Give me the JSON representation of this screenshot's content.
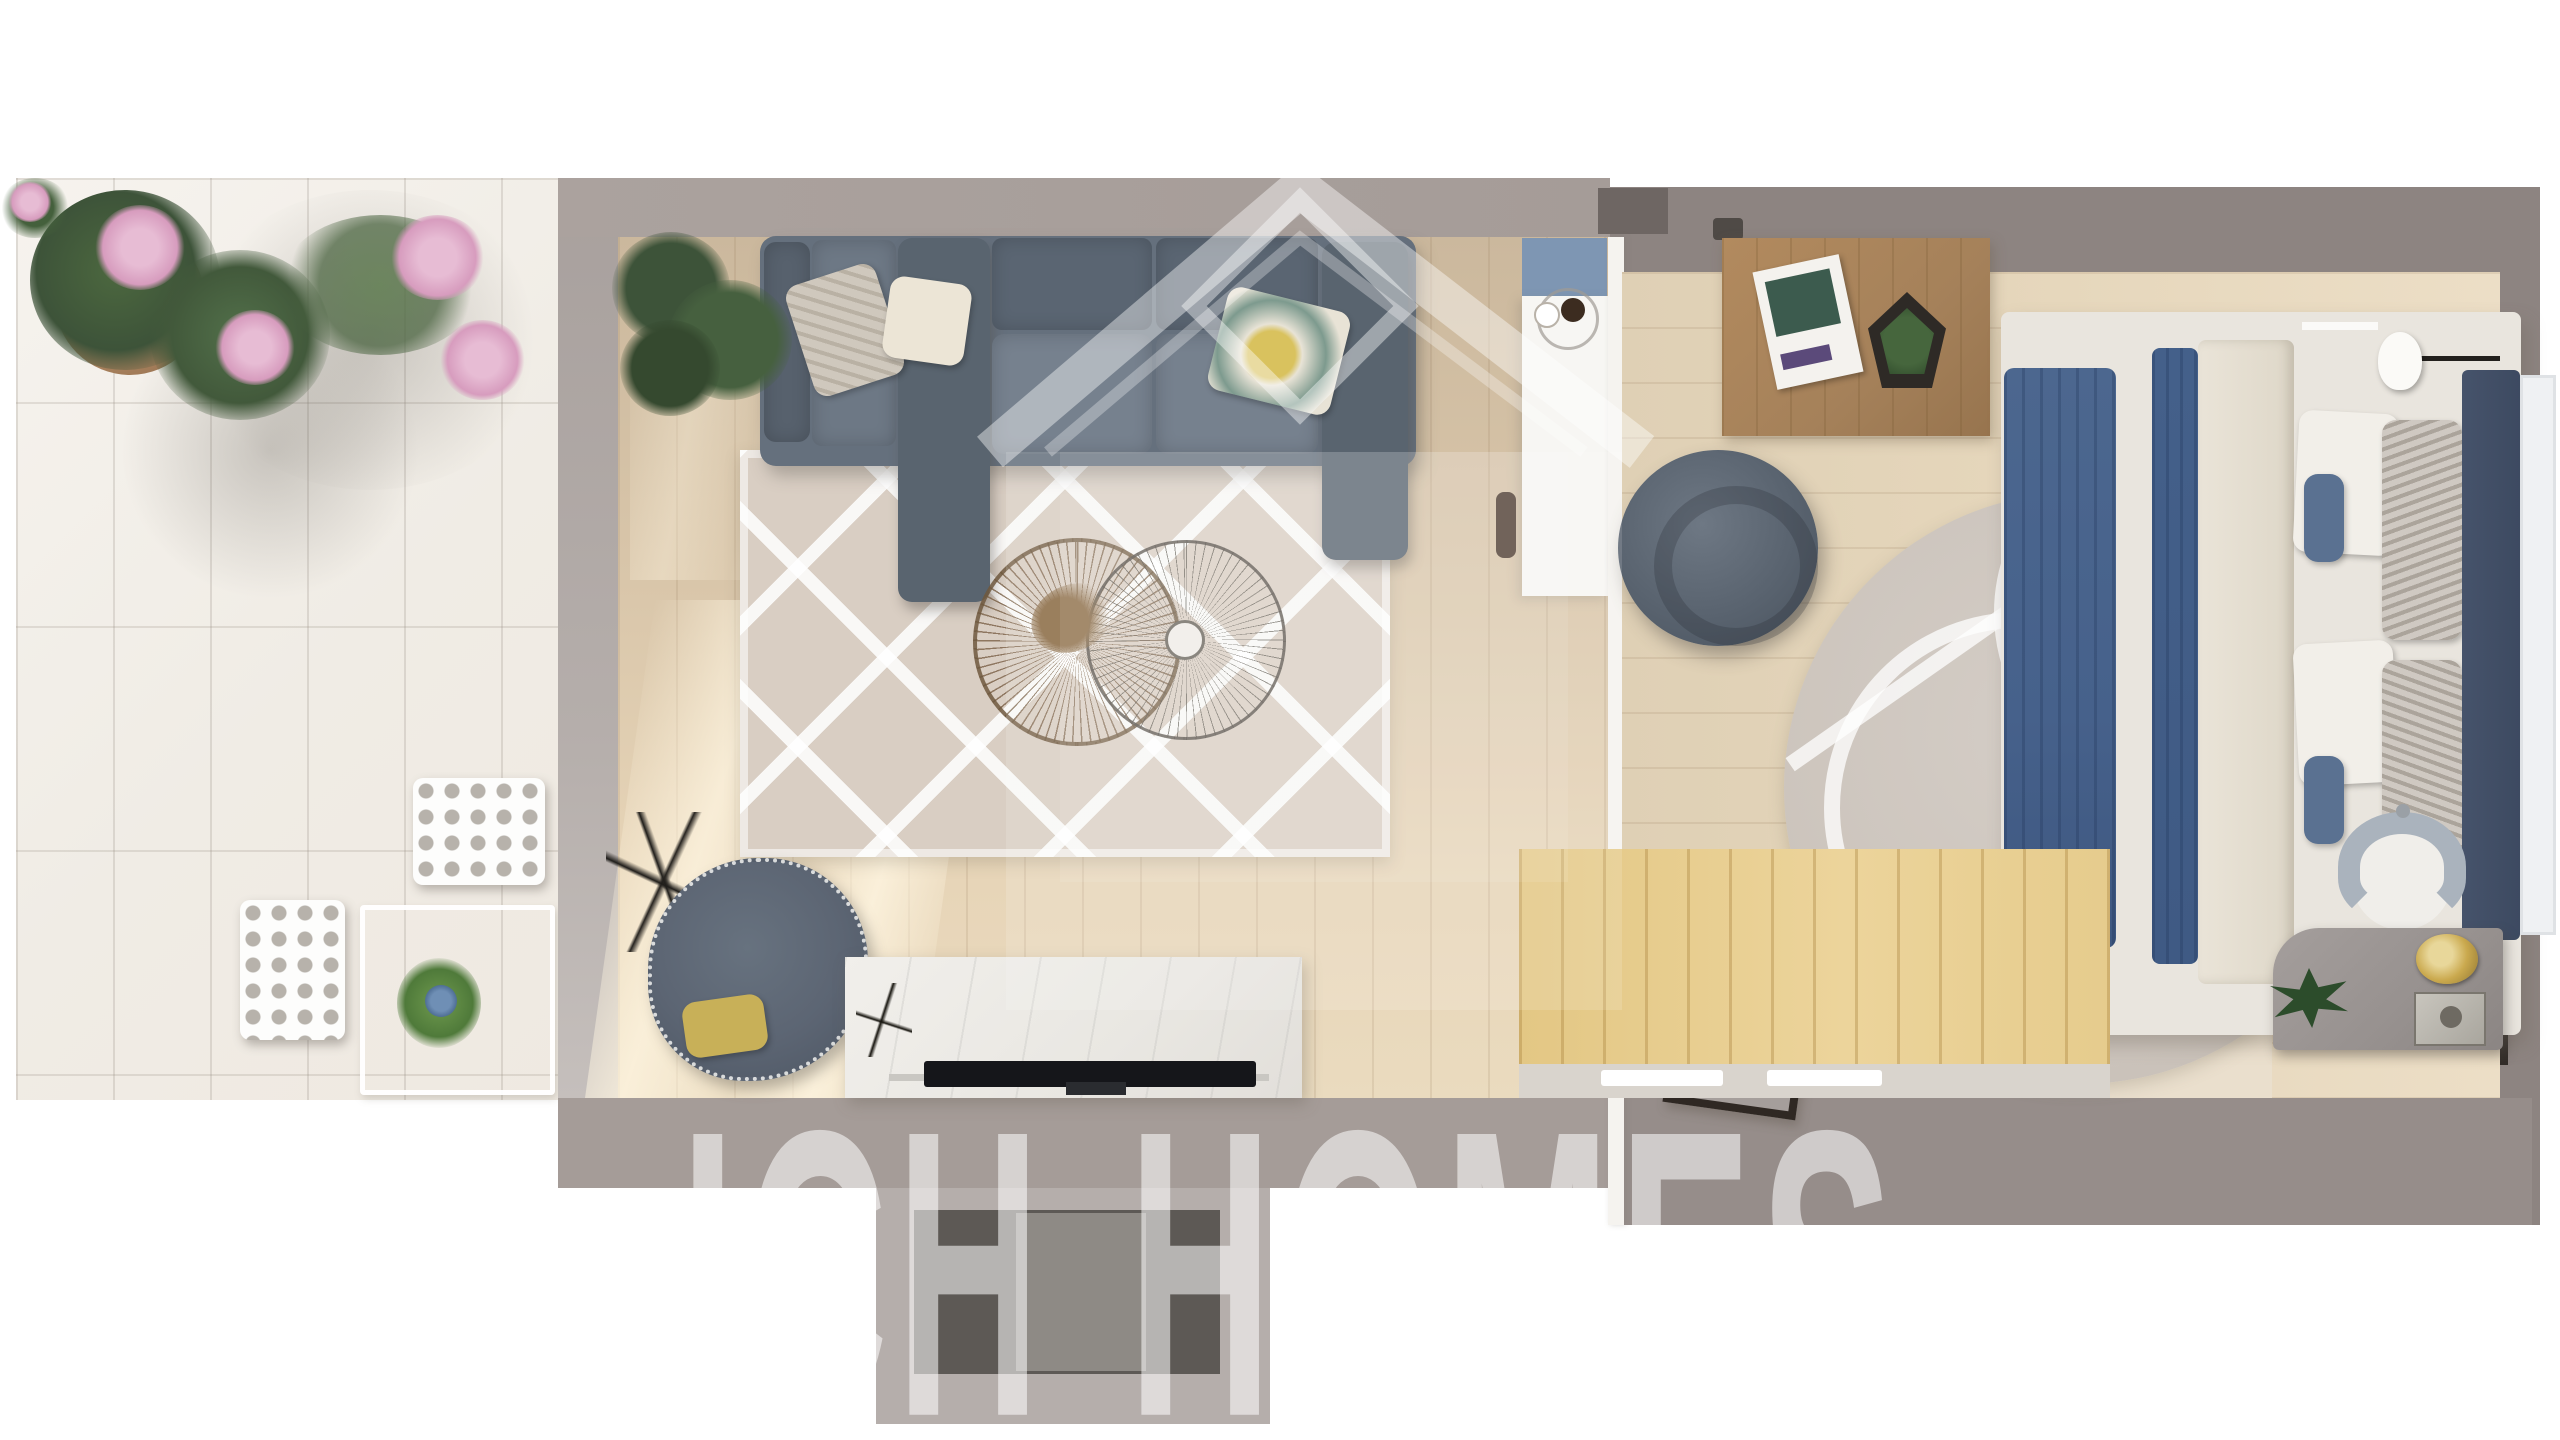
{
  "watermark": {
    "brand_text": "ICH HOMES",
    "logo": "house-outline-icon",
    "text_color": "#ffffff",
    "text_opacity": 0.55
  },
  "scene": {
    "description": "top-down 3D rendered apartment floor plan",
    "rooms": [
      "terrace",
      "living-room",
      "bedroom"
    ],
    "terrace_items": [
      "corner-plant",
      "potted-oleander-pink-flowers",
      "lattice-cube-stool",
      "lattice-cube-stool",
      "glass-side-table",
      "blue-flower-pot"
    ],
    "living_room_items": [
      "sectional-sofa",
      "paisley-pillow",
      "cream-pillow",
      "floral-yellow-pillow",
      "fiddle-leaf-plant",
      "diamond-pattern-rug",
      "wire-coffee-table-large",
      "wire-coffee-table-small",
      "dried-flower-centerpiece",
      "swivel-armchair",
      "yellow-lumbar-pillow",
      "dried-twig-decor",
      "marble-tv-console",
      "flat-tv",
      "airplane-sculpture"
    ],
    "bedroom_items": [
      "wooden-media-table",
      "magazine",
      "geometric-terrarium",
      "double-bed",
      "blue-duvet",
      "white-duvet",
      "white-pillows",
      "gray-patterned-pillows",
      "blue-cushions",
      "upholstered-headboard",
      "headboard-bench",
      "wall-lamp-top",
      "wall-lamp-bottom",
      "round-rug",
      "donut-pouf",
      "magazine-rack",
      "desk",
      "desk-chair",
      "desk-plant",
      "gold-mirror",
      "metal-box",
      "wood-deck-strip",
      "kitchen-counter",
      "coffee-cup-tray",
      "door-handle"
    ]
  },
  "palette": {
    "background": "#ffffff",
    "wall_light": "#a59c98",
    "wall_dark": "#8d8481",
    "terrace_floor": "#f2efe9",
    "living_floor": "#d9c6aa",
    "bedroom_floor": "#e6d7bc",
    "deck_wood": "#e7cd92",
    "sofa": "#6d7885",
    "sofa_dark": "#59646f",
    "rug_beige": "#d9cec3",
    "round_rug": "#cdc5bd",
    "duvet_blue": "#46618b",
    "headboard_navy": "#3d4a61",
    "counter_blue": "#7e96b3",
    "accent_yellow": "#c8b058",
    "plant_green": "#3d5339",
    "flower_pink": "#d79cbe",
    "marble_white": "#edebe7"
  }
}
